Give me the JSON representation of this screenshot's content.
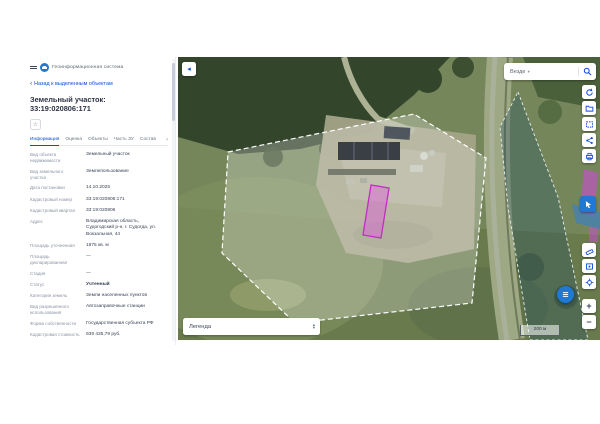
{
  "header": {
    "app_title": "Геоинформационная система"
  },
  "navigation": {
    "back_label": "Назад к выделенным объектам"
  },
  "object_card": {
    "title": "Земельный участок: 33:19:020806:171",
    "tabs": [
      {
        "label": "Информация"
      },
      {
        "label": "Оценка"
      },
      {
        "label": "Объекты"
      },
      {
        "label": "Часть ЗУ"
      },
      {
        "label": "Состав"
      }
    ],
    "fields": [
      {
        "label": "Вид объекта недвижимости",
        "value": "Земельный участок"
      },
      {
        "label": "Вид земельного участка",
        "value": "Землепользование"
      },
      {
        "label": "Дата постановки",
        "value": "14.10.2025"
      },
      {
        "label": "Кадастровый номер",
        "value": "33:19:020806:171"
      },
      {
        "label": "Кадастровый квартал",
        "value": "33:19:020806"
      },
      {
        "label": "Адрес",
        "value": "Владимирская область, Судогодский р-н, г. Судогда, ул. Вокзальная, 44"
      },
      {
        "label": "Площадь уточненная",
        "value": "1875 кв. м"
      },
      {
        "label": "Площадь декларированная",
        "value": "—"
      },
      {
        "label": "Стадия",
        "value": "—"
      },
      {
        "label": "Статус",
        "value": "Учтенный"
      },
      {
        "label": "Категория земель",
        "value": "Земли населенных пунктов"
      },
      {
        "label": "Вид разрешенного использования",
        "value": "Автозаправочные станции"
      },
      {
        "label": "Форма собственности",
        "value": "Государственная субъекта РФ"
      },
      {
        "label": "Кадастровая стоимость",
        "value": "939 435,79 руб."
      }
    ]
  },
  "map": {
    "search_scope_label": "Везде",
    "legend_label": "Легенда",
    "scale_label": "200 м",
    "zoom_in_label": "+",
    "zoom_out_label": "−",
    "colors": {
      "accent": "#0d4cd3",
      "action_blue": "#1f78d1",
      "selected_parcel_fill": "#e05bde",
      "selected_parcel_stroke": "#c12ec2",
      "parcel_outline": "#ffffff",
      "zone_fill": "#235064"
    }
  },
  "icons": {
    "back": "‹",
    "collapse": "◂",
    "caret_down": "▾",
    "chevron_right": "›",
    "favorite": "☆",
    "sort_up": "▴",
    "sort_down": "▾"
  }
}
